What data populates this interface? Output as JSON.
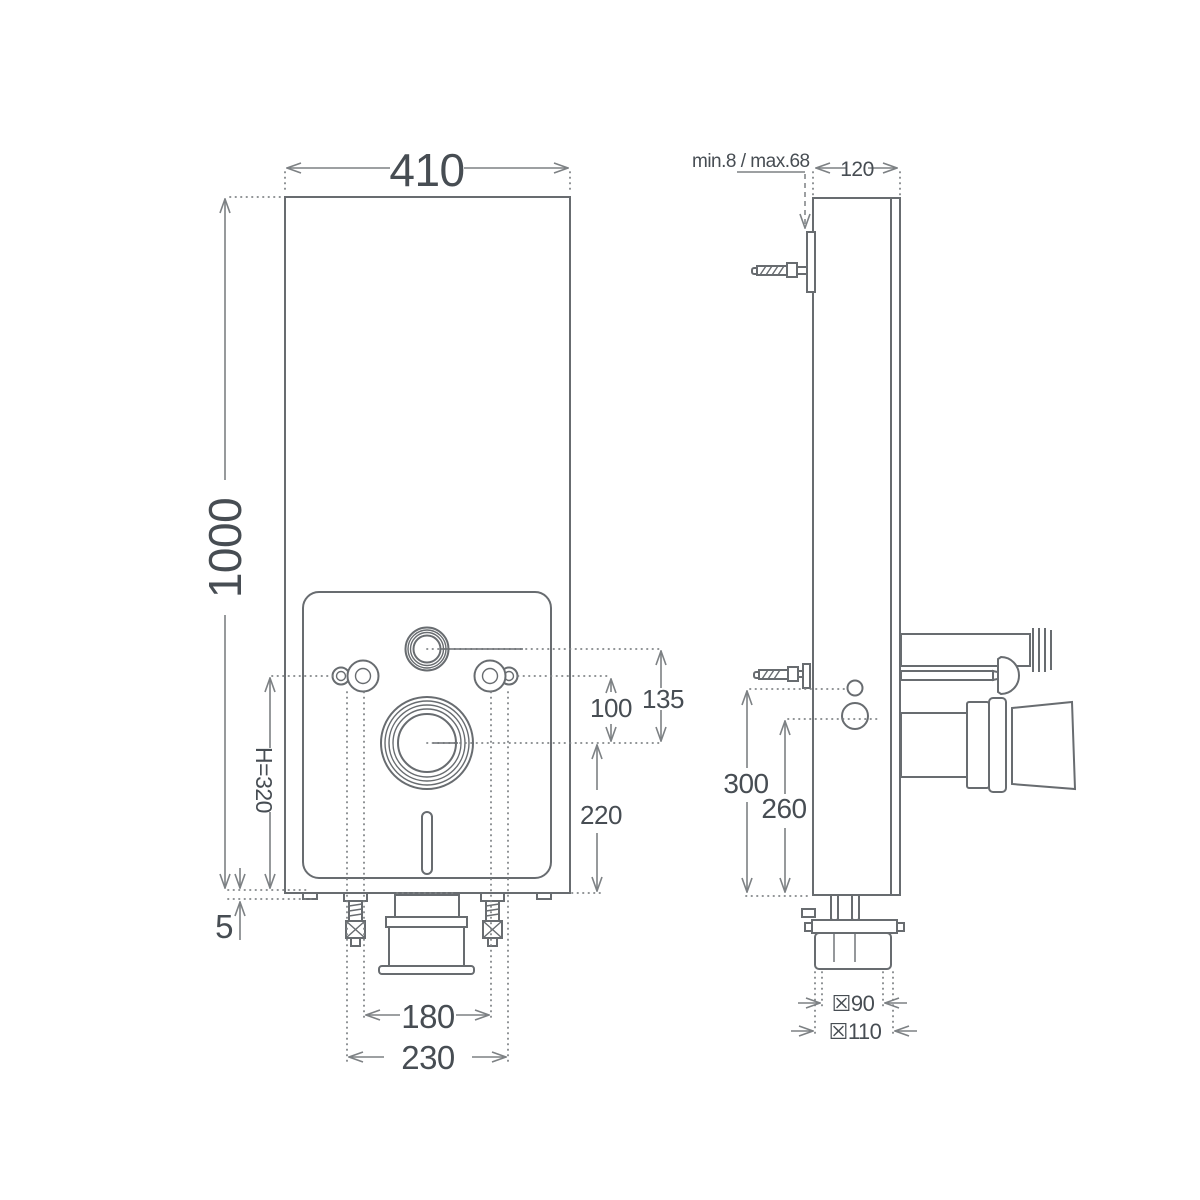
{
  "front_view": {
    "width": "410",
    "height": "1000",
    "cistern_offset": "135",
    "fixing_offset": "100",
    "outlet_height": "220",
    "flush_height": "H=320",
    "floor_gap": "5",
    "inner_spacing": "180",
    "outer_spacing": "230"
  },
  "side_view": {
    "depth": "120",
    "bracket_range": "min.8 / max.68",
    "supply_height": "300",
    "flush_pipe_height": "260",
    "outlet_d90": "☒90",
    "outlet_d110": "☒110"
  },
  "colors": {
    "object_line": "#686c70",
    "dimension_line": "#7d8184",
    "text": "#474d53",
    "background": "#ffffff"
  }
}
